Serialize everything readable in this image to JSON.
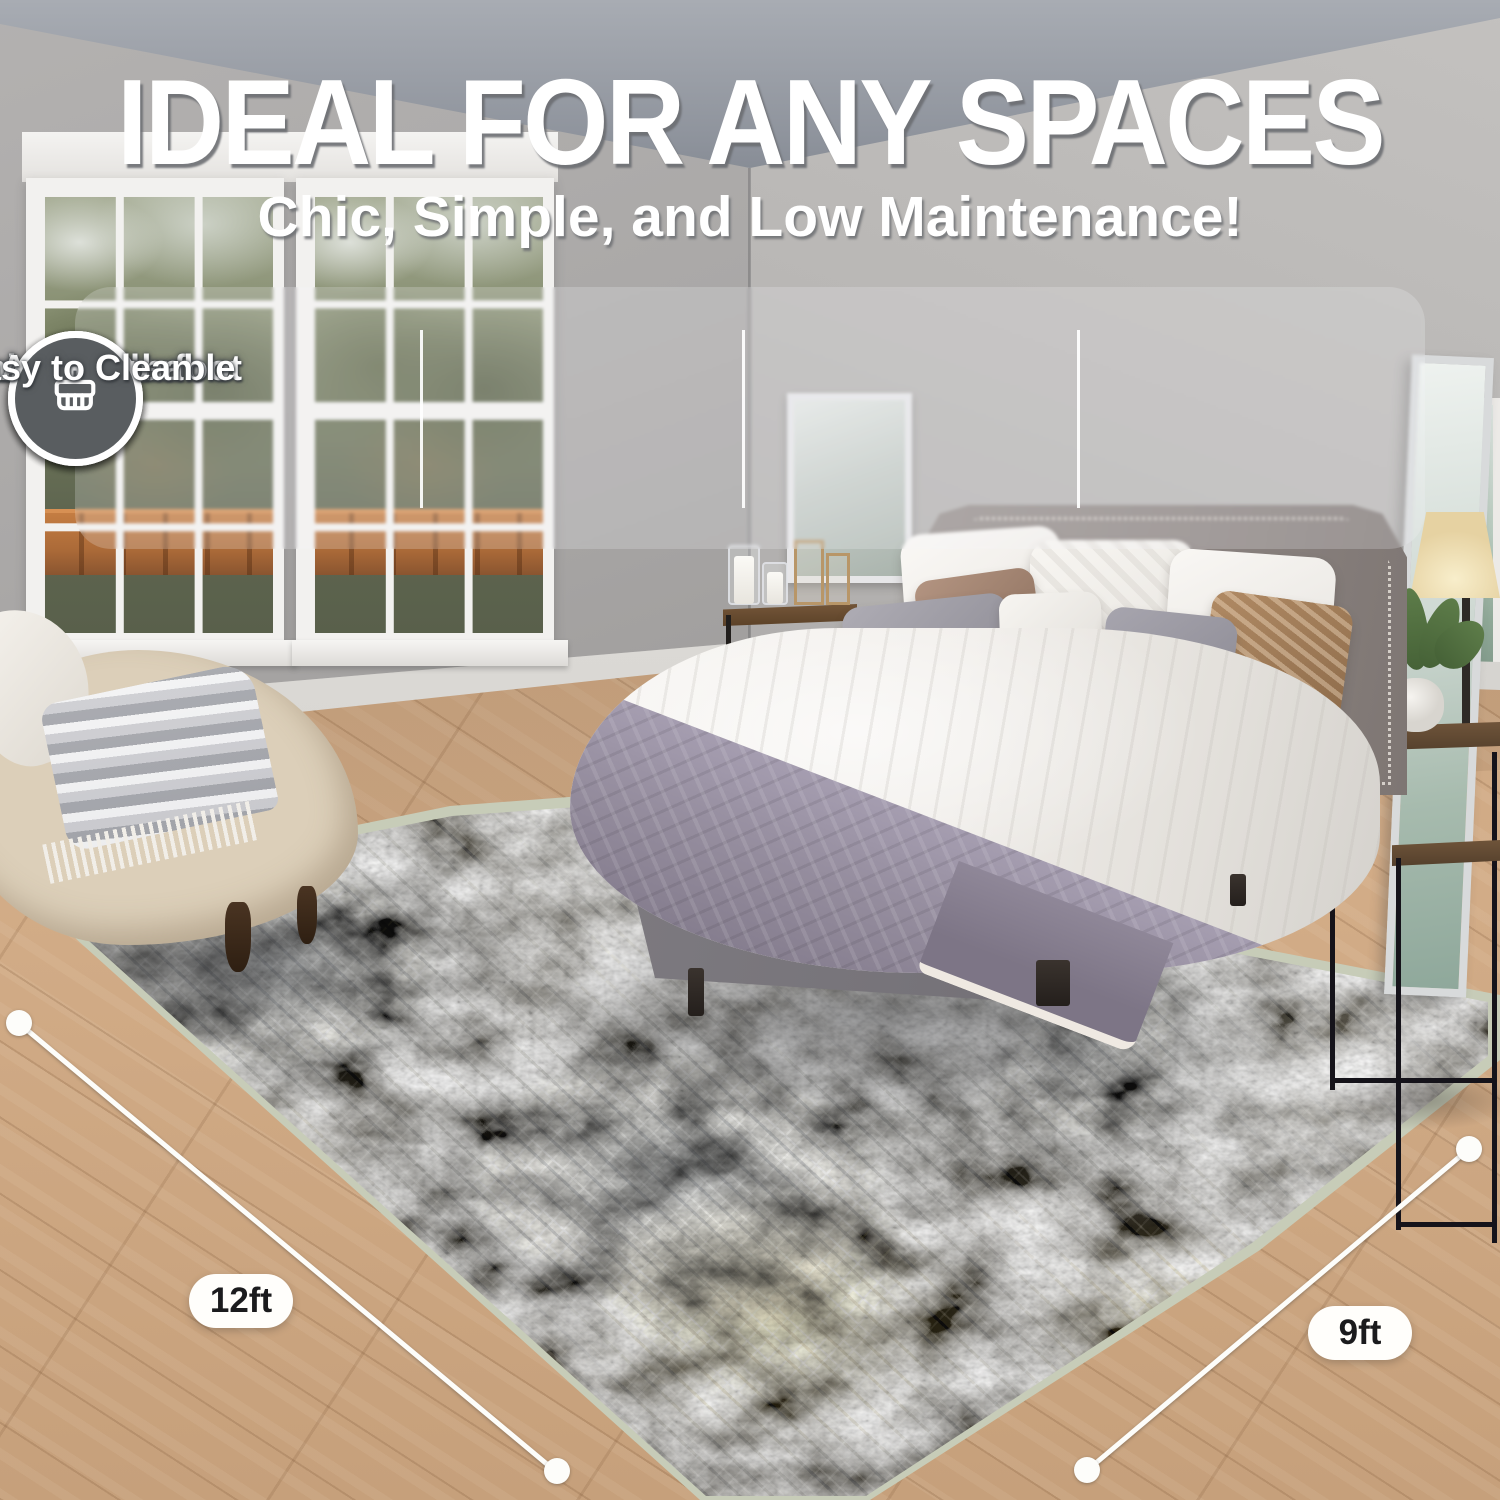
{
  "headline": {
    "title": "IDEAL FOR ANY SPACES",
    "subtitle": "Chic, Simple, and Low Maintenance!"
  },
  "features": [
    {
      "icon": "feather-icon",
      "label": "Softness Underfoot"
    },
    {
      "icon": "washing-machine-icon",
      "label": "Machine Washable"
    },
    {
      "icon": "anti-slip-icon",
      "label": "Anti-Slip"
    },
    {
      "icon": "cleaning-brush-icon",
      "label": "Easy to Clean"
    }
  ],
  "measurements": {
    "width": "12ft",
    "depth": "9ft"
  },
  "colors": {
    "icon_circle": "#595d60",
    "overlay_panel": "rgba(248,248,250,0.22)",
    "pill_bg": "#fffefb",
    "pill_text": "#1b1b1d",
    "rug_border": "#c7ccb8",
    "text": "#ffffff"
  }
}
